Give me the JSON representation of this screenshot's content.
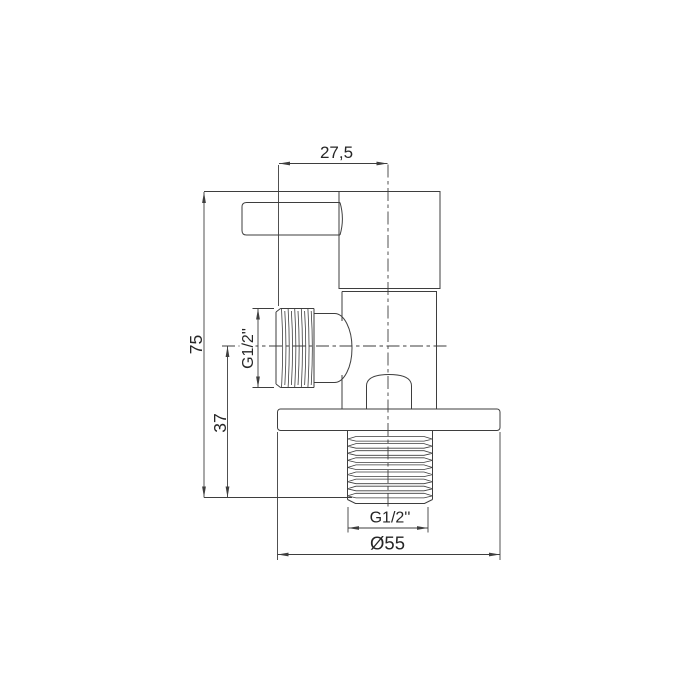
{
  "title": "Angle valve technical drawing",
  "labels": {
    "width_top": "27,5",
    "height_total": "75",
    "height_to_axis": "37",
    "side_thread": "G1/2''",
    "bottom_thread": "G1/2''",
    "flange_diameter": "Ø55"
  },
  "colors": {
    "line": "#3e3e3e",
    "text": "#262626",
    "background": "#ffffff"
  }
}
